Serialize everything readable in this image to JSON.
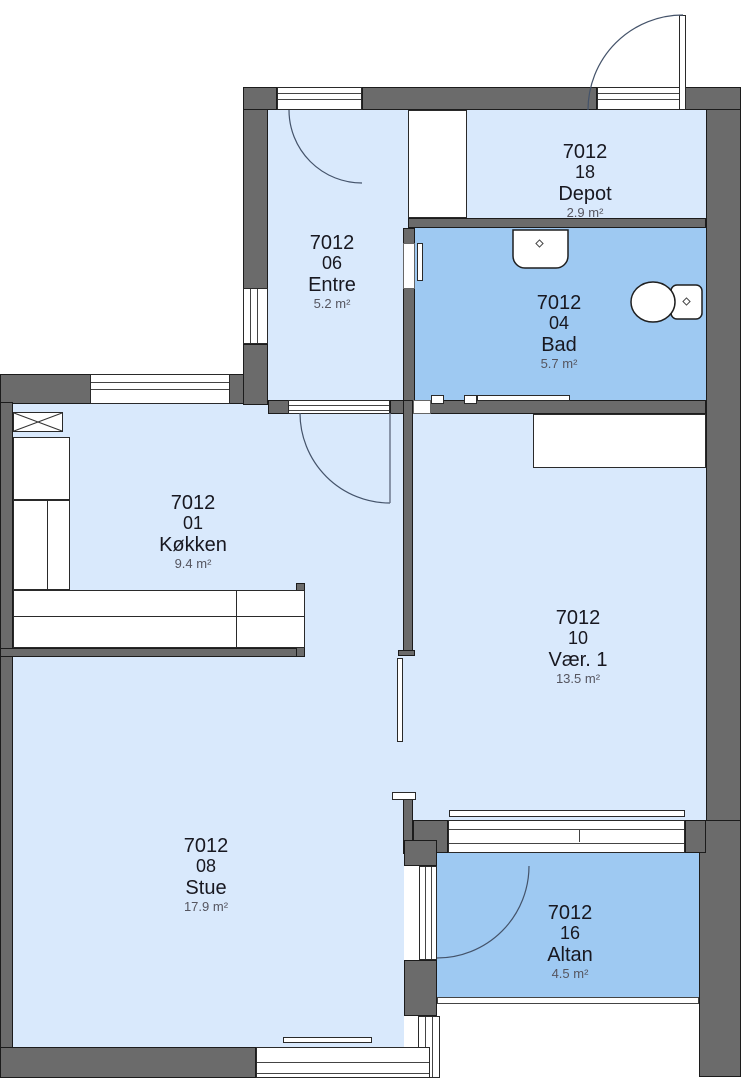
{
  "plan": {
    "title": "Apartment 7012 floor plan",
    "units_suffix": "m²"
  },
  "rooms": [
    {
      "id": "entre",
      "number": "7012",
      "unit": "06",
      "name": "Entre",
      "area": "5.2 m²"
    },
    {
      "id": "depot",
      "number": "7012",
      "unit": "18",
      "name": "Depot",
      "area": "2.9 m²"
    },
    {
      "id": "bad",
      "number": "7012",
      "unit": "04",
      "name": "Bad",
      "area": "5.7 m²"
    },
    {
      "id": "koekken",
      "number": "7012",
      "unit": "01",
      "name": "Køkken",
      "area": "9.4 m²"
    },
    {
      "id": "vaer1",
      "number": "7012",
      "unit": "10",
      "name": "Vær. 1",
      "area": "13.5 m²"
    },
    {
      "id": "stue",
      "number": "7012",
      "unit": "08",
      "name": "Stue",
      "area": "17.9 m²"
    },
    {
      "id": "altan",
      "number": "7012",
      "unit": "16",
      "name": "Altan",
      "area": "4.5 m²"
    }
  ],
  "colors": {
    "wall": "#6b6b6b",
    "wall_outline": "#1c1c1c",
    "room_light": "#d9e9fc",
    "room_medium": "#9ec9f2",
    "door_arc": "#44536a",
    "label_text": "#181820",
    "area_text": "#55555f"
  },
  "fixtures": [
    "sink",
    "toilet",
    "wardrobe",
    "kitchen-counter",
    "vent-box",
    "balcony-railing"
  ]
}
